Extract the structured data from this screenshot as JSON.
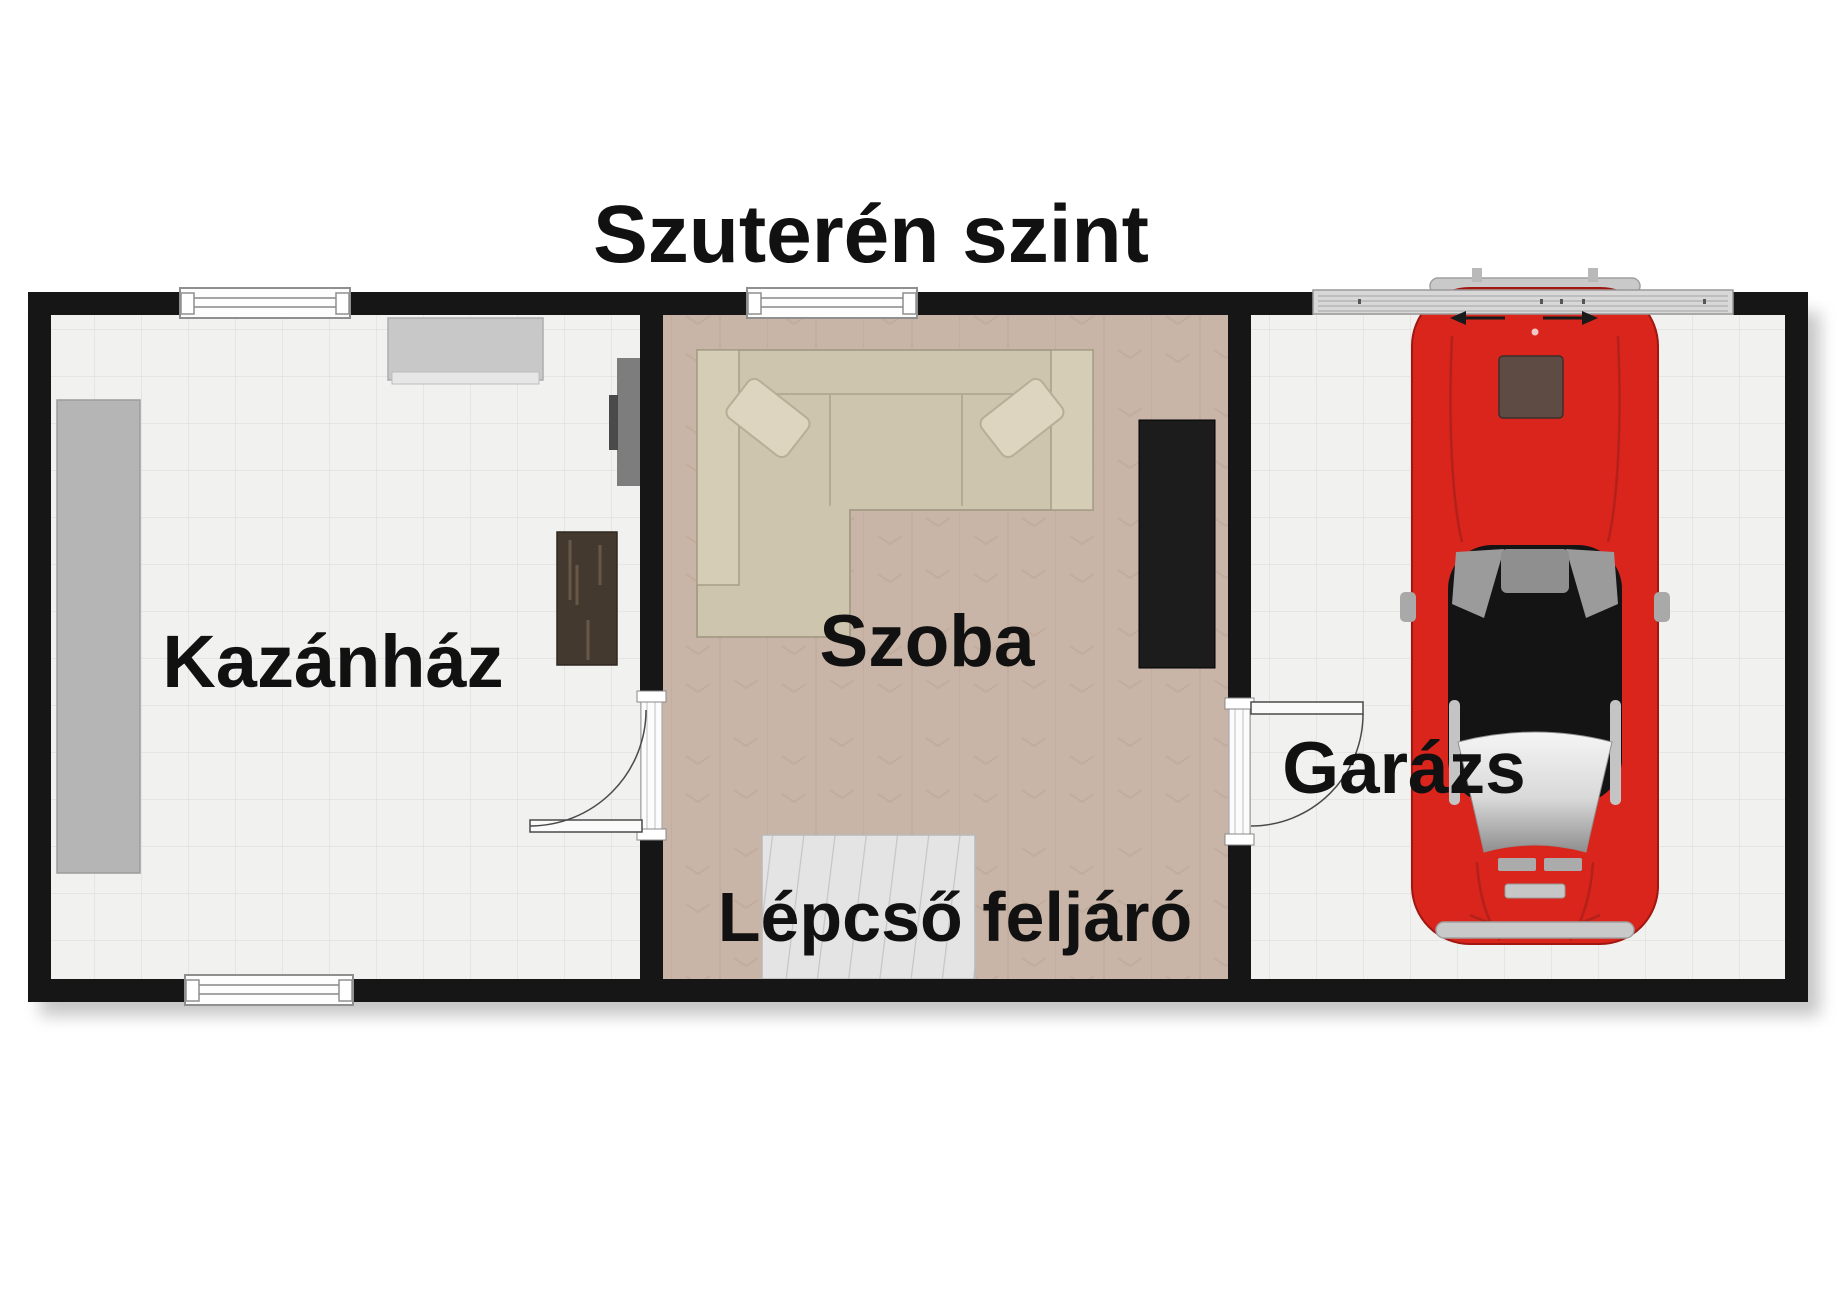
{
  "title": "Szuterén szint",
  "rooms": {
    "boiler": {
      "label": "Kazánház"
    },
    "living": {
      "label": "Szoba"
    },
    "stairs": {
      "label": "Lépcső feljáró"
    },
    "garage": {
      "label": "Garázs"
    }
  },
  "colors": {
    "text": "#111111",
    "wall": "#161616",
    "tile_base": "#f1f1f0",
    "tile_grout": "#e2e1df",
    "wood_base": "#c9b5a7",
    "wood_grain": "#a98f7e",
    "stair_base": "#e4e4e4",
    "stair_step": "#c6c6c6",
    "sofa": "#cec5af",
    "sofa_edge": "#a89f89",
    "pillow": "#ddd5bf",
    "sideboard": "#1c1c1c",
    "bench": "#44392f",
    "counter": "#b5b5b5",
    "appliance": "#c8c8c8",
    "panel": "#7d7d7d",
    "garage_door": "#d8d8d8",
    "car_red": "#d9251c",
    "car_glass": "#141414",
    "chrome": "#c9c9c9"
  }
}
